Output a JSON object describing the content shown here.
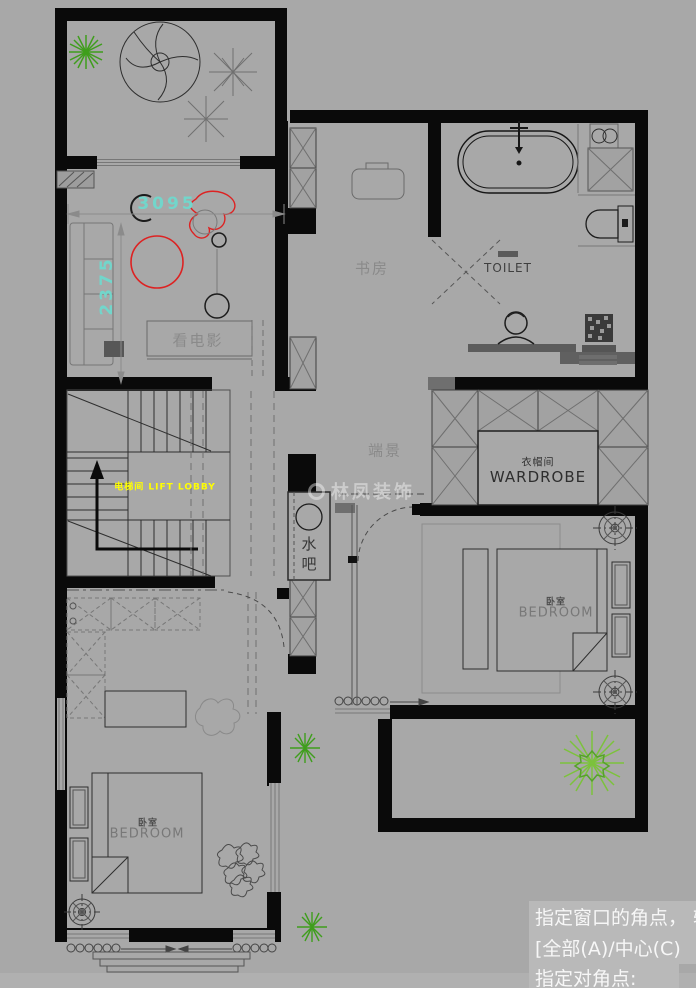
{
  "canvas": {
    "width": 696,
    "height": 988,
    "background": "#a8a8a8"
  },
  "watermark": {
    "brand": "林凤装饰"
  },
  "dimensions": {
    "horizontal": "3095",
    "vertical": "2375",
    "color": "#72d6cb"
  },
  "labels": {
    "home_theater": "看电影",
    "study": "书房",
    "toilet": "TOILET",
    "end_scene": "端景",
    "wardrobe_cn": "衣帽间",
    "wardrobe_en": "WARDROBE",
    "water_bar": "水吧",
    "master_bedroom_cn": "卧室",
    "master_bedroom_en": "BEDROOM",
    "second_bedroom_cn": "卧室",
    "second_bedroom_en": "BEDROOM",
    "lift_lobby": "电梯间 LIFT LOBBY"
  },
  "accent_colors": {
    "red": "#dd2222",
    "yellow": "#ffff00",
    "green": "#3f9e1c",
    "light_green": "#7cc23c"
  },
  "command_line": {
    "lines": [
      "指定窗口的角点， 输",
      "[全部(A)/中心(C)",
      "指定对角点:"
    ]
  }
}
